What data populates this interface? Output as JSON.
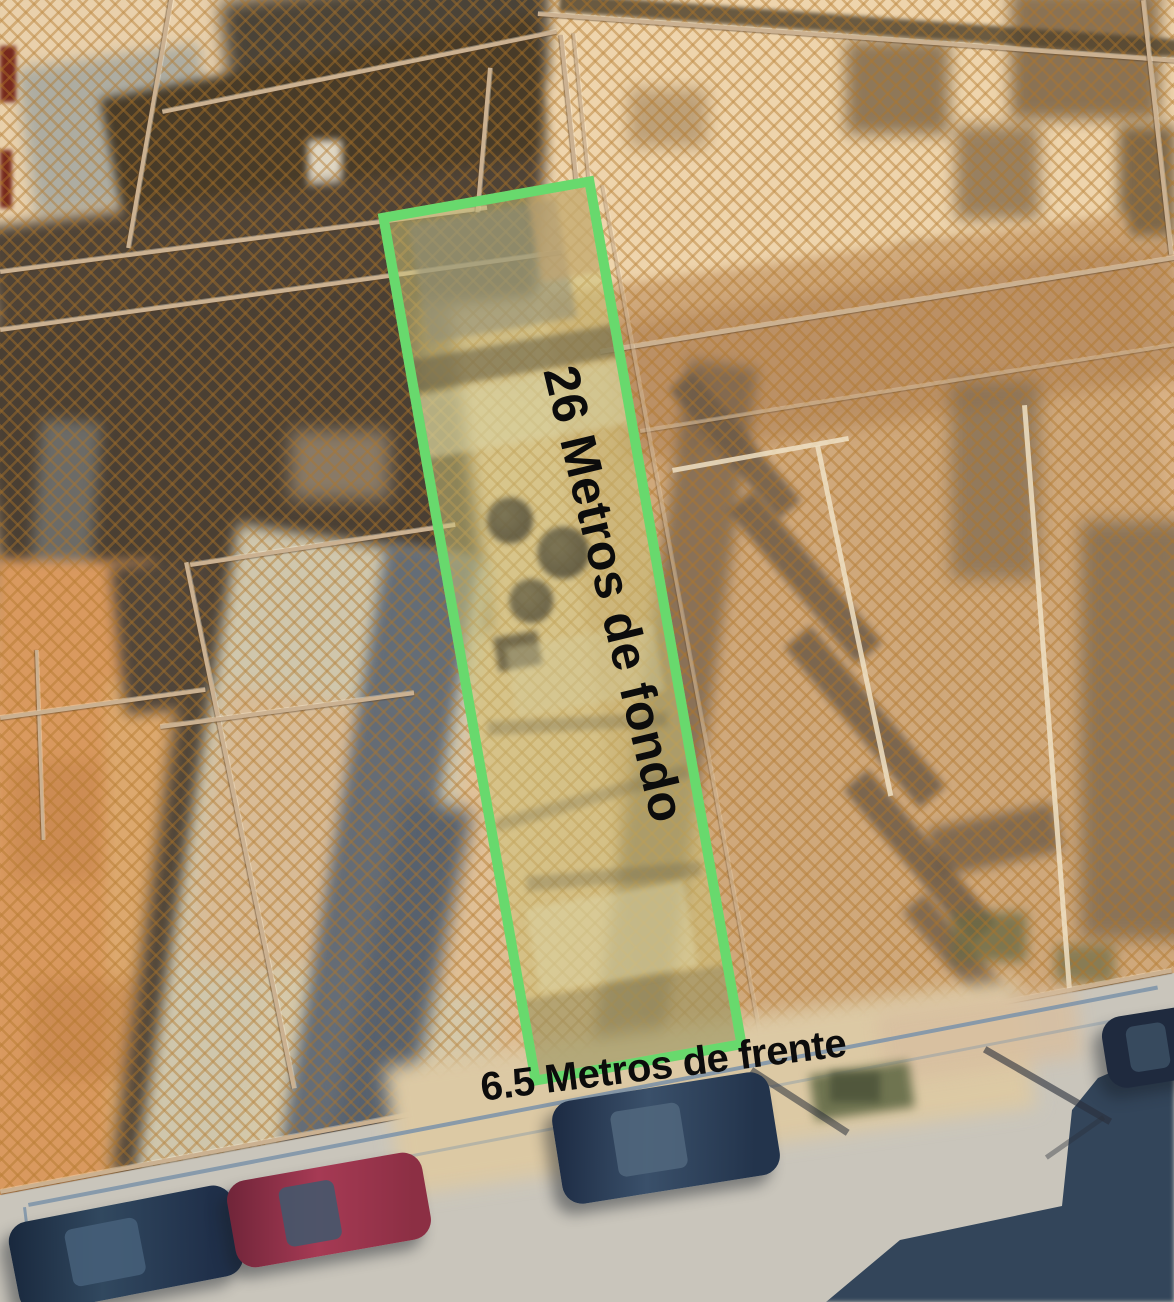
{
  "annotations": {
    "depth_label": "26 Metros de fondo",
    "frontage_label": "6.5 Metros de frente"
  },
  "measurements": {
    "depth_meters": "26",
    "frontage_meters": "6.5"
  },
  "colors": {
    "plot_outline_green": "#68d96d",
    "plot_fill_tint": "#cbc47a",
    "hatch_pattern": "#b07628",
    "label_text": "#0c0c0c",
    "road": "#33455a",
    "sidewalk": "#c9c5bb"
  }
}
